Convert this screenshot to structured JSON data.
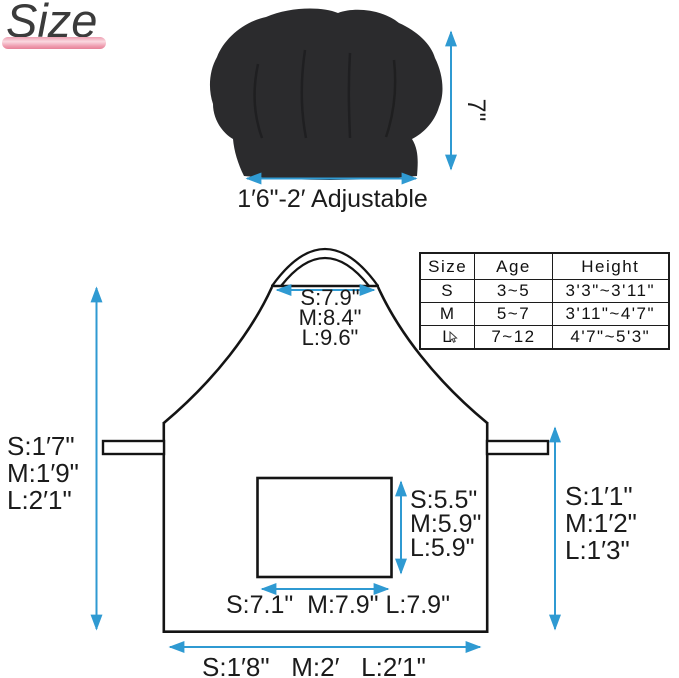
{
  "title": "Size",
  "hat": {
    "height_label": "7\"",
    "width_label": "1′6\"-2′ Adjustable"
  },
  "table": {
    "headers": [
      "Size",
      "Age",
      "Height"
    ],
    "rows": [
      [
        "S",
        "3~5",
        "3'3\"~3'11\""
      ],
      [
        "M",
        "5~7",
        "3'11\"~4'7\""
      ],
      [
        "L",
        "7~12",
        "4'7\"~5'3\""
      ]
    ]
  },
  "apron": {
    "neck_width": [
      "S:7.9\"",
      "M:8.4\"",
      "L:9.6\""
    ],
    "left_height": [
      "S:1′7\"",
      "M:1′9\"",
      "L:2′1\""
    ],
    "right_height": [
      "S:1′1\"",
      "M:1′2\"",
      "L:1′3\""
    ],
    "pocket_height": [
      "S:5.5\"",
      "M:5.9\"",
      "L:5.9\""
    ],
    "pocket_width": "S:7.1\"  M:7.9\" L:7.9\"",
    "bottom_width": "S:1′8\"   M:2′   L:2′1\""
  },
  "colors": {
    "arrow": "#2f9ad2",
    "line": "#141414",
    "hat_fill": "#2b2b2d",
    "accent_bar": "#ee9aad"
  }
}
